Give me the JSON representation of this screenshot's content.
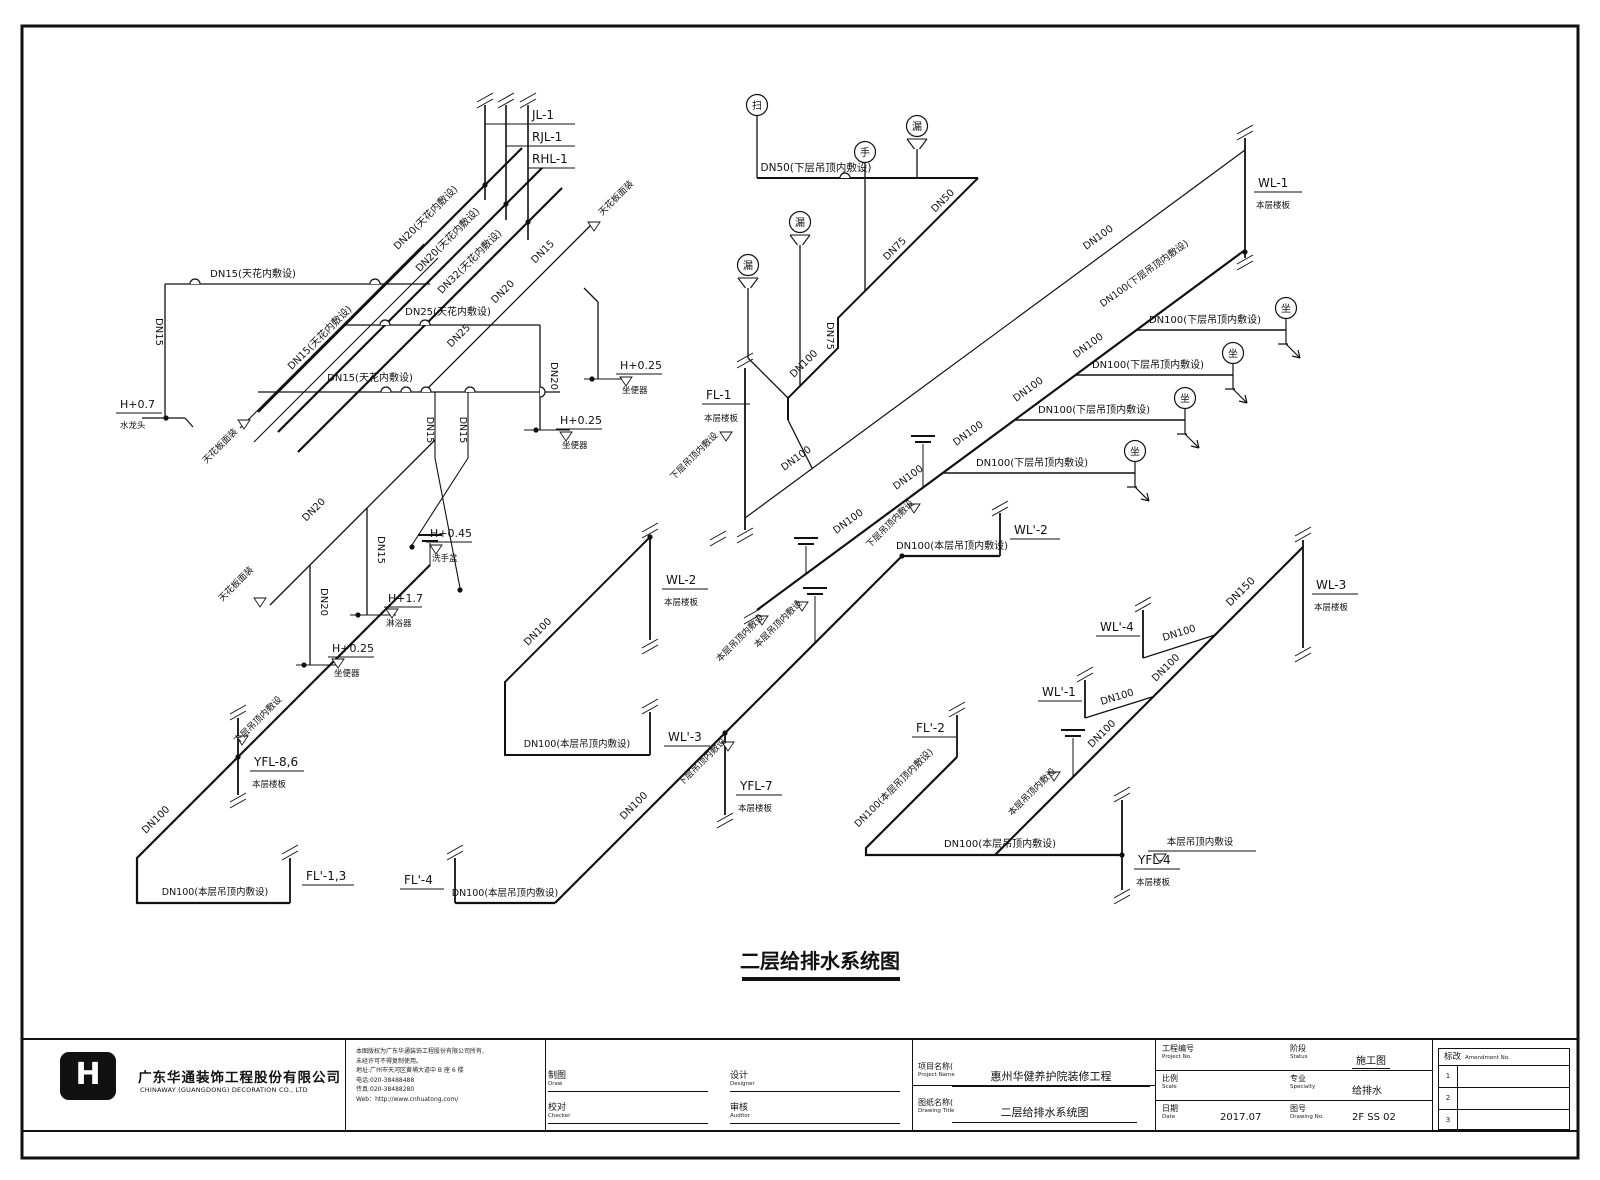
{
  "titleblock": {
    "company_cn": "广东华通装饰工程股份有限公司",
    "company_en": "CHINAWAY (GUANGDONG) DECORATION CO., LTD",
    "notice_lines": [
      "本图版权为广东华通装饰工程股份有限公司所有,",
      "未经许可不得复制使用。",
      "地址:广州市天河区黄埔大道中 B 座 6 楼",
      "电话:020-38488488",
      "传真:020-38488280",
      "Web：http://www.cnhuatong.com/"
    ],
    "sign_fields": [
      {
        "cn": "制图",
        "en": "Draw"
      },
      {
        "cn": "校对",
        "en": "Checker"
      },
      {
        "cn": "设计",
        "en": "Designer"
      },
      {
        "cn": "审核",
        "en": "Auditor"
      }
    ],
    "project_label_cn": "项目名称(",
    "project_label_en": "Project Name",
    "project_value": "惠州华健养护院装修工程",
    "drawing_label_cn": "图纸名称(",
    "drawing_label_en": "Drawing Title",
    "drawing_value": "二层给排水系统图",
    "meta": [
      {
        "cn": "工程编号",
        "en": "Project No.",
        "value": "",
        "ul": false
      },
      {
        "cn": "阶段",
        "en": "Status",
        "value": "施工图",
        "ul": true
      },
      {
        "cn": "比例",
        "en": "Scale",
        "value": "",
        "ul": false
      },
      {
        "cn": "专业",
        "en": "Specialty",
        "value": "给排水",
        "ul": false
      },
      {
        "cn": "日期",
        "en": "Date",
        "value": "2017.07",
        "ul": false
      },
      {
        "cn": "图号",
        "en": "Drawing No.",
        "value": "2F SS 02",
        "ul": false
      }
    ],
    "revision": {
      "cn": "标改",
      "en": "Amendment No.",
      "rows": [
        "1",
        "2",
        "3"
      ]
    }
  },
  "diagram": {
    "title": "二层给排水系统图",
    "pipes": [
      {
        "d": "M258,412 L522,148 M278,432 L542,168 M298,452 L562,188",
        "w": 2.2
      },
      {
        "d": "M757,610 L1245,250",
        "w": 2.2
      },
      {
        "d": "M555,903 L902,556",
        "w": 2.2
      },
      {
        "d": "M430,565 L137,858 L137,903 L290,903",
        "w": 2.2
      },
      {
        "d": "M995,855 L1303,547",
        "w": 2.2
      },
      {
        "d": "M957,757 L866,848 L866,855 L1122,855",
        "w": 2.2
      },
      {
        "d": "M455,903 L555,903",
        "w": 2.2
      },
      {
        "d": "M902,556 L1000,556",
        "w": 2.2
      },
      {
        "d": "M650,537 L505,682 L505,755 L650,755",
        "w": 2
      },
      {
        "d": "M978,178 L838,318 L838,348 L788,398 L788,420",
        "w": 2
      },
      {
        "d": "M757,178 L978,178",
        "w": 2
      },
      {
        "d": "M485,105 V200 M506,105 V220 M528,105 V240",
        "w": 1.6
      },
      {
        "d": "M745,368 V530 M1245,138 V258 M650,537 V640 M650,712 V755 M238,718 V795 M290,858 V903 M455,858 V903 M725,733 V815 M1000,513 V556 M1303,540 V648 M1143,610 V658 M1085,680 V718 M957,715 V757 M1122,800 V890",
        "w": 1.8
      },
      {
        "d": "M745,518 L1245,150",
        "w": 1.2
      },
      {
        "d": "M1137,330 H1286 M1075,375 H1233 M1014,420 H1185 M942,473 H1135",
        "w": 1.6
      },
      {
        "d": "M1143,658 L1215,635 M1085,718 L1152,697",
        "w": 1.3
      },
      {
        "d": "M485,124 H575 M506,146 H575 M528,168 H575",
        "w": 0.9
      },
      {
        "d": "M165,284 H430 M165,284 V418",
        "w": 1.3
      },
      {
        "d": "M142,418 H185 M185,418 l8,9",
        "w": 1.2
      },
      {
        "d": "M240,428 L424,244 M254,442 L438,258",
        "w": 1.1
      },
      {
        "d": "M258,392 H560",
        "w": 1.3
      },
      {
        "d": "M345,325 H540",
        "w": 1.3
      },
      {
        "d": "M424,392 L594,222",
        "w": 1.3
      },
      {
        "d": "M540,325 V430",
        "w": 1.3
      },
      {
        "d": "M598,302 V379 M584,288 L598,302",
        "w": 1.3
      },
      {
        "d": "M435,392 V458 M468,392 V458 M435,458 L460,588 M468,458 L412,545",
        "w": 1.1
      },
      {
        "d": "M270,605 L435,440",
        "w": 1.3
      },
      {
        "d": "M310,565 V665 M367,508 V615",
        "w": 1.3
      },
      {
        "d": "M524,430 H570 M584,379 H628 M350,615 H396 M296,665 H340",
        "w": 1.1
      },
      {
        "d": "M757,116 V178 M865,163 V291 M917,149 V178 M800,245 V386 M748,288 V358 M748,358 L788,398",
        "w": 1.3
      },
      {
        "d": "M788,420 L812,468",
        "w": 1.3
      },
      {
        "d": "M806,546 V574 M923,444 V487 M1073,738 V777 M430,543 V565 M815,596 V643",
        "w": 1
      },
      {
        "d": "M1148,851 H1256",
        "w": 0.9
      },
      {
        "d": "M742,979 H900",
        "w": 4
      }
    ],
    "texts": [
      {
        "t": "JL-1",
        "x": 532,
        "y": 119,
        "s": 12
      },
      {
        "t": "RJL-1",
        "x": 532,
        "y": 141,
        "s": 12
      },
      {
        "t": "RHL-1",
        "x": 532,
        "y": 163,
        "s": 12
      },
      {
        "t": "DN20(天花内敷设)",
        "x": 428,
        "y": 220,
        "r": -45,
        "a": "m"
      },
      {
        "t": "DN20(天花内敷设)",
        "x": 450,
        "y": 242,
        "r": -45,
        "a": "m"
      },
      {
        "t": "DN32(天花内敷设)",
        "x": 472,
        "y": 264,
        "r": -45,
        "a": "m"
      },
      {
        "t": "DN15(天花内敷设)",
        "x": 253,
        "y": 277,
        "a": "m"
      },
      {
        "t": "DN15",
        "x": 156,
        "y": 332,
        "r": 90,
        "a": "m"
      },
      {
        "t": "H+0.7",
        "x": 120,
        "y": 408,
        "s": 11,
        "u": 46
      },
      {
        "t": "水龙头",
        "x": 120,
        "y": 428,
        "s": 8.5
      },
      {
        "t": "DN15(天花内敷设)",
        "x": 322,
        "y": 340,
        "r": -45,
        "a": "m"
      },
      {
        "t": "天花板面装",
        "x": 222,
        "y": 448,
        "r": -45,
        "a": "m",
        "s": 9
      },
      {
        "t": "DN15(天花内敷设)",
        "x": 370,
        "y": 381,
        "a": "m"
      },
      {
        "t": "DN25(天花内敷设)",
        "x": 448,
        "y": 315,
        "a": "m"
      },
      {
        "t": "DN25",
        "x": 461,
        "y": 338,
        "r": -45,
        "a": "m"
      },
      {
        "t": "DN20",
        "x": 505,
        "y": 294,
        "r": -45,
        "a": "m"
      },
      {
        "t": "DN15",
        "x": 545,
        "y": 254,
        "r": -45,
        "a": "m"
      },
      {
        "t": "天花板面装",
        "x": 618,
        "y": 200,
        "r": -45,
        "a": "m",
        "s": 9
      },
      {
        "t": "DN20",
        "x": 551,
        "y": 376,
        "r": 90,
        "a": "m"
      },
      {
        "t": "H+0.25",
        "x": 560,
        "y": 424,
        "s": 11,
        "u": 46
      },
      {
        "t": "坐便器",
        "x": 562,
        "y": 448,
        "s": 8.5
      },
      {
        "t": "H+0.25",
        "x": 620,
        "y": 369,
        "s": 11,
        "u": 46
      },
      {
        "t": "坐便器",
        "x": 622,
        "y": 393,
        "s": 8.5
      },
      {
        "t": "DN15",
        "x": 427,
        "y": 430,
        "r": 90,
        "a": "m",
        "s": 9.5
      },
      {
        "t": "DN15",
        "x": 460,
        "y": 430,
        "r": 90,
        "a": "m",
        "s": 9.5
      },
      {
        "t": "H+0.45",
        "x": 430,
        "y": 537,
        "s": 11,
        "u": 46
      },
      {
        "t": "洗手盆",
        "x": 432,
        "y": 561,
        "s": 8.5
      },
      {
        "t": "DN20",
        "x": 316,
        "y": 512,
        "r": -45,
        "a": "m"
      },
      {
        "t": "天花板面装",
        "x": 238,
        "y": 586,
        "r": -45,
        "a": "m",
        "s": 9
      },
      {
        "t": "DN20",
        "x": 321,
        "y": 602,
        "r": 90,
        "a": "m"
      },
      {
        "t": "H+0.25",
        "x": 332,
        "y": 652,
        "s": 11,
        "u": 46
      },
      {
        "t": "坐便器",
        "x": 334,
        "y": 676,
        "s": 8.5
      },
      {
        "t": "DN15",
        "x": 378,
        "y": 550,
        "r": 90,
        "a": "m"
      },
      {
        "t": "H+1.7",
        "x": 388,
        "y": 602,
        "s": 11,
        "u": 38
      },
      {
        "t": "淋浴器",
        "x": 386,
        "y": 626,
        "s": 8.5
      },
      {
        "t": "DN50(下层吊顶内敷设)",
        "x": 816,
        "y": 171,
        "a": "m",
        "s": 10.5
      },
      {
        "t": "DN50",
        "x": 945,
        "y": 203,
        "r": -45,
        "a": "m"
      },
      {
        "t": "DN75",
        "x": 897,
        "y": 251,
        "r": -45,
        "a": "m"
      },
      {
        "t": "DN75",
        "x": 827,
        "y": 336,
        "r": 90,
        "a": "m"
      },
      {
        "t": "DN100",
        "x": 806,
        "y": 366,
        "r": -45,
        "a": "m"
      },
      {
        "t": "FL-1",
        "x": 706,
        "y": 399,
        "s": 12,
        "u": 48
      },
      {
        "t": "本层楼板",
        "x": 704,
        "y": 421,
        "s": 8.5
      },
      {
        "t": "下层吊顶内敷设",
        "x": 696,
        "y": 458,
        "r": -45,
        "a": "m",
        "s": 9
      },
      {
        "t": "DN100",
        "x": 798,
        "y": 461,
        "r": -36,
        "a": "m"
      },
      {
        "t": "DN100",
        "x": 1100,
        "y": 240,
        "r": -36,
        "a": "m"
      },
      {
        "t": "DN100(下层吊顶内敷设)",
        "x": 1146,
        "y": 276,
        "r": -36,
        "a": "m",
        "s": 9.5
      },
      {
        "t": "DN100",
        "x": 850,
        "y": 524,
        "r": -36,
        "a": "m"
      },
      {
        "t": "DN100",
        "x": 910,
        "y": 480,
        "r": -36,
        "a": "m"
      },
      {
        "t": "DN100",
        "x": 970,
        "y": 436,
        "r": -36,
        "a": "m"
      },
      {
        "t": "DN100",
        "x": 1030,
        "y": 392,
        "r": -36,
        "a": "m"
      },
      {
        "t": "DN100",
        "x": 1090,
        "y": 348,
        "r": -36,
        "a": "m"
      },
      {
        "t": "WL-1",
        "x": 1258,
        "y": 187,
        "s": 12,
        "u": 48
      },
      {
        "t": "本层楼板",
        "x": 1256,
        "y": 208,
        "s": 8.5
      },
      {
        "t": "DN100(下层吊顶内敷设)",
        "x": 1205,
        "y": 323,
        "a": "m"
      },
      {
        "t": "DN100(下层吊顶内敷设)",
        "x": 1148,
        "y": 368,
        "a": "m"
      },
      {
        "t": "DN100(下层吊顶内敷设)",
        "x": 1094,
        "y": 413,
        "a": "m"
      },
      {
        "t": "DN100(下层吊顶内敷设)",
        "x": 1032,
        "y": 466,
        "a": "m"
      },
      {
        "t": "本层吊顶内敷设",
        "x": 742,
        "y": 640,
        "r": -45,
        "a": "m",
        "s": 9
      },
      {
        "t": "本层吊顶内敷设",
        "x": 780,
        "y": 626,
        "r": -45,
        "a": "m",
        "s": 9
      },
      {
        "t": "下层吊顶内敷设",
        "x": 892,
        "y": 526,
        "r": -45,
        "a": "m",
        "s": 9
      },
      {
        "t": "DN100(本层吊顶内敷设)",
        "x": 952,
        "y": 549,
        "a": "m"
      },
      {
        "t": "WL'-2",
        "x": 1014,
        "y": 534,
        "s": 12,
        "u": 50
      },
      {
        "t": "DN100",
        "x": 636,
        "y": 808,
        "r": -45,
        "a": "m"
      },
      {
        "t": "下层吊顶内敷设",
        "x": 704,
        "y": 764,
        "r": -45,
        "a": "m",
        "s": 9
      },
      {
        "t": "YFL-7",
        "x": 740,
        "y": 790,
        "s": 12,
        "u": 46
      },
      {
        "t": "本层楼板",
        "x": 738,
        "y": 811,
        "s": 8.5
      },
      {
        "t": "DN100(本层吊顶内敷设)",
        "x": 505,
        "y": 896,
        "a": "m",
        "s": 9.5
      },
      {
        "t": "FL'-4",
        "x": 404,
        "y": 884,
        "s": 12,
        "u": 44
      },
      {
        "t": "DN100",
        "x": 540,
        "y": 634,
        "r": -45,
        "a": "m"
      },
      {
        "t": "WL-2",
        "x": 666,
        "y": 584,
        "s": 12,
        "u": 46
      },
      {
        "t": "本层楼板",
        "x": 664,
        "y": 605,
        "s": 8.5
      },
      {
        "t": "DN100(本层吊顶内敷设)",
        "x": 577,
        "y": 747,
        "a": "m",
        "s": 9.5
      },
      {
        "t": "WL'-3",
        "x": 668,
        "y": 741,
        "s": 12,
        "u": 46
      },
      {
        "t": "DN100",
        "x": 158,
        "y": 822,
        "r": -45,
        "a": "m"
      },
      {
        "t": "下层吊顶内敷设",
        "x": 260,
        "y": 722,
        "r": -45,
        "a": "m",
        "s": 9
      },
      {
        "t": "YFL-8,6",
        "x": 254,
        "y": 766,
        "s": 12,
        "u": 54
      },
      {
        "t": "本层楼板",
        "x": 252,
        "y": 787,
        "s": 8.5
      },
      {
        "t": "DN100(本层吊顶内敷设)",
        "x": 215,
        "y": 895,
        "a": "m",
        "s": 9.5
      },
      {
        "t": "FL'-1,3",
        "x": 306,
        "y": 880,
        "s": 12,
        "u": 52
      },
      {
        "t": "DN150",
        "x": 1243,
        "y": 594,
        "r": -45,
        "a": "m",
        "s": 10.5
      },
      {
        "t": "DN100",
        "x": 1168,
        "y": 670,
        "r": -45,
        "a": "m"
      },
      {
        "t": "DN100",
        "x": 1104,
        "y": 736,
        "r": -45,
        "a": "m"
      },
      {
        "t": "WL-3",
        "x": 1316,
        "y": 589,
        "s": 12,
        "u": 46
      },
      {
        "t": "本层楼板",
        "x": 1314,
        "y": 610,
        "s": 8.5
      },
      {
        "t": "WL'-4",
        "x": 1100,
        "y": 631,
        "s": 12,
        "u": 44
      },
      {
        "t": "DN100",
        "x": 1180,
        "y": 636,
        "r": -17,
        "a": "m"
      },
      {
        "t": "WL'-1",
        "x": 1042,
        "y": 696,
        "s": 12,
        "u": 44
      },
      {
        "t": "DN100",
        "x": 1118,
        "y": 700,
        "r": -17,
        "a": "m"
      },
      {
        "t": "本层吊顶内敷设",
        "x": 1034,
        "y": 794,
        "r": -45,
        "a": "m",
        "s": 9
      },
      {
        "t": "FL'-2",
        "x": 916,
        "y": 732,
        "s": 12,
        "u": 44
      },
      {
        "t": "DN100(本层吊顶内敷设)",
        "x": 896,
        "y": 790,
        "r": -45,
        "a": "m",
        "s": 9.5
      },
      {
        "t": "DN100(本层吊顶内敷设)",
        "x": 1000,
        "y": 847,
        "a": "m"
      },
      {
        "t": "本层吊顶内敷设",
        "x": 1200,
        "y": 845,
        "a": "m",
        "s": 9.5
      },
      {
        "t": "YFL-4",
        "x": 1138,
        "y": 864,
        "s": 12,
        "u": 46
      },
      {
        "t": "本层楼板",
        "x": 1136,
        "y": 885,
        "s": 8.5
      },
      {
        "t": "二层给排水系统图",
        "x": 820,
        "y": 968,
        "a": "m",
        "s": 20,
        "b": 1
      }
    ],
    "syms": [
      {
        "c": "扫",
        "x": 757,
        "y": 105
      },
      {
        "c": "手",
        "x": 865,
        "y": 152
      },
      {
        "c": "漏",
        "x": 917,
        "y": 126,
        "f": 1
      },
      {
        "c": "漏",
        "x": 800,
        "y": 222,
        "f": 1
      },
      {
        "c": "漏",
        "x": 748,
        "y": 265,
        "f": 1
      },
      {
        "c": "坐",
        "x": 1286,
        "y": 308
      },
      {
        "c": "坐",
        "x": 1233,
        "y": 353
      },
      {
        "c": "坐",
        "x": 1185,
        "y": 398
      },
      {
        "c": "坐",
        "x": 1135,
        "y": 451
      }
    ],
    "drops": [
      [
        1286,
        330
      ],
      [
        1233,
        375
      ],
      [
        1185,
        420
      ],
      [
        1135,
        473
      ]
    ],
    "dots": [
      [
        485,
        185
      ],
      [
        506,
        204
      ],
      [
        528,
        222
      ],
      [
        166,
        418
      ],
      [
        536,
        430
      ],
      [
        592,
        379
      ],
      [
        358,
        615
      ],
      [
        304,
        665
      ],
      [
        412,
        547
      ],
      [
        460,
        590
      ],
      [
        238,
        757
      ],
      [
        725,
        733
      ],
      [
        1122,
        855
      ],
      [
        1245,
        252
      ],
      [
        650,
        537
      ],
      [
        902,
        556
      ]
    ],
    "brks": [
      [
        485,
        98
      ],
      [
        506,
        98
      ],
      [
        528,
        98
      ],
      [
        745,
        358
      ],
      [
        745,
        533
      ],
      [
        1245,
        130
      ],
      [
        1245,
        260
      ],
      [
        1000,
        506
      ],
      [
        650,
        528
      ],
      [
        650,
        644
      ],
      [
        650,
        704
      ],
      [
        725,
        818
      ],
      [
        455,
        850
      ],
      [
        290,
        850
      ],
      [
        238,
        710
      ],
      [
        238,
        798
      ],
      [
        1303,
        532
      ],
      [
        1303,
        652
      ],
      [
        1143,
        602
      ],
      [
        1085,
        672
      ],
      [
        957,
        707
      ],
      [
        1122,
        792
      ],
      [
        1122,
        894
      ],
      [
        752,
        614
      ],
      [
        718,
        536
      ]
    ],
    "vents": [
      [
        806,
        538
      ],
      [
        923,
        436
      ],
      [
        1073,
        730
      ],
      [
        430,
        535
      ],
      [
        815,
        588
      ]
    ],
    "tris": [
      [
        244,
        424
      ],
      [
        594,
        226
      ],
      [
        566,
        436
      ],
      [
        626,
        381
      ],
      [
        436,
        549
      ],
      [
        338,
        663
      ],
      [
        392,
        613
      ],
      [
        260,
        602
      ],
      [
        726,
        436
      ],
      [
        762,
        620
      ],
      [
        802,
        606
      ],
      [
        914,
        508
      ],
      [
        728,
        746
      ],
      [
        242,
        740
      ],
      [
        1054,
        776
      ],
      [
        1160,
        858
      ]
    ],
    "bumps": [
      [
        195,
        284,
        0
      ],
      [
        375,
        284,
        0
      ],
      [
        386,
        392,
        0
      ],
      [
        406,
        392,
        0
      ],
      [
        426,
        392,
        0
      ],
      [
        470,
        392,
        0
      ],
      [
        385,
        325,
        0
      ],
      [
        425,
        325,
        0
      ],
      [
        540,
        392,
        90
      ],
      [
        845,
        178,
        0
      ]
    ]
  }
}
